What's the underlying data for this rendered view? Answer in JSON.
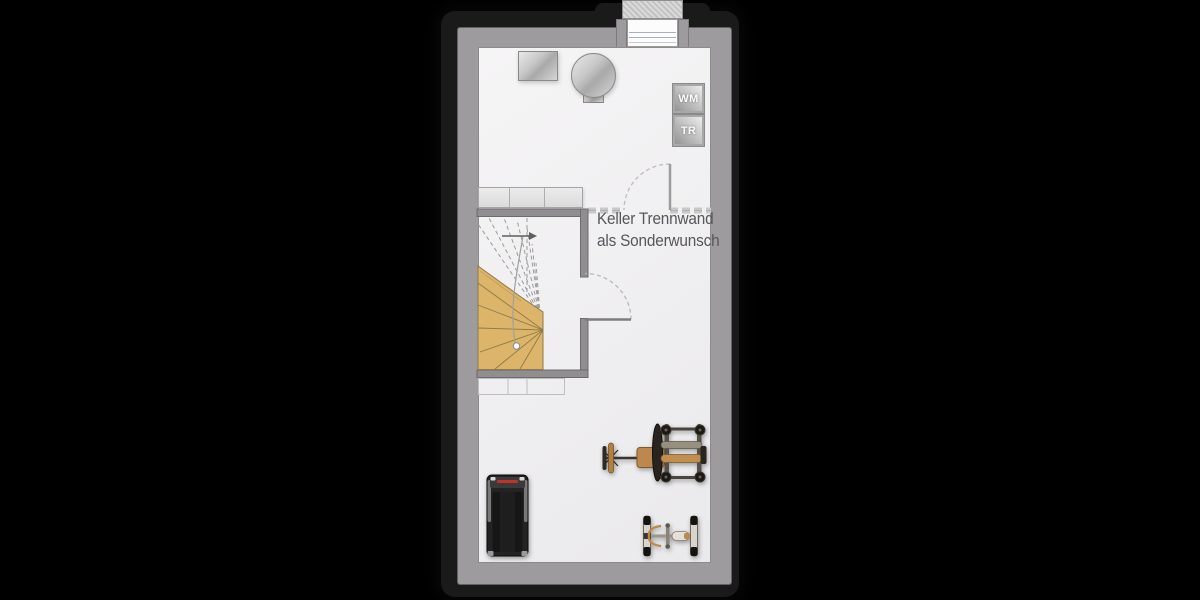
{
  "annotation": {
    "line1": "Keller Trennwand",
    "line2": "als Sonderwunsch"
  },
  "appliances": {
    "washing_machine_label": "WM",
    "dryer_label": "TR"
  },
  "colors": {
    "background": "#000000",
    "frame": "#1a1a1a",
    "wall": "#9d9b9d",
    "floor": "#f1f0f1",
    "partition_dash": "#c9c8c9",
    "stair_wood": "#dcb56b",
    "annotation_text": "#57565a"
  },
  "objects": {
    "top_zone": [
      "chimney-vent-block",
      "basement-window",
      "heating-unit",
      "boiler-tank",
      "washing-machine",
      "dryer"
    ],
    "middle_zone": [
      "storage-shelf-upper",
      "stair-enclosure",
      "winder-staircase",
      "partition-wall-dashed",
      "partition-door",
      "stair-door",
      "ghost-shelf-lower"
    ],
    "bottom_zone": [
      "treadmill",
      "weight-bench-machine",
      "barbell-rack"
    ]
  }
}
